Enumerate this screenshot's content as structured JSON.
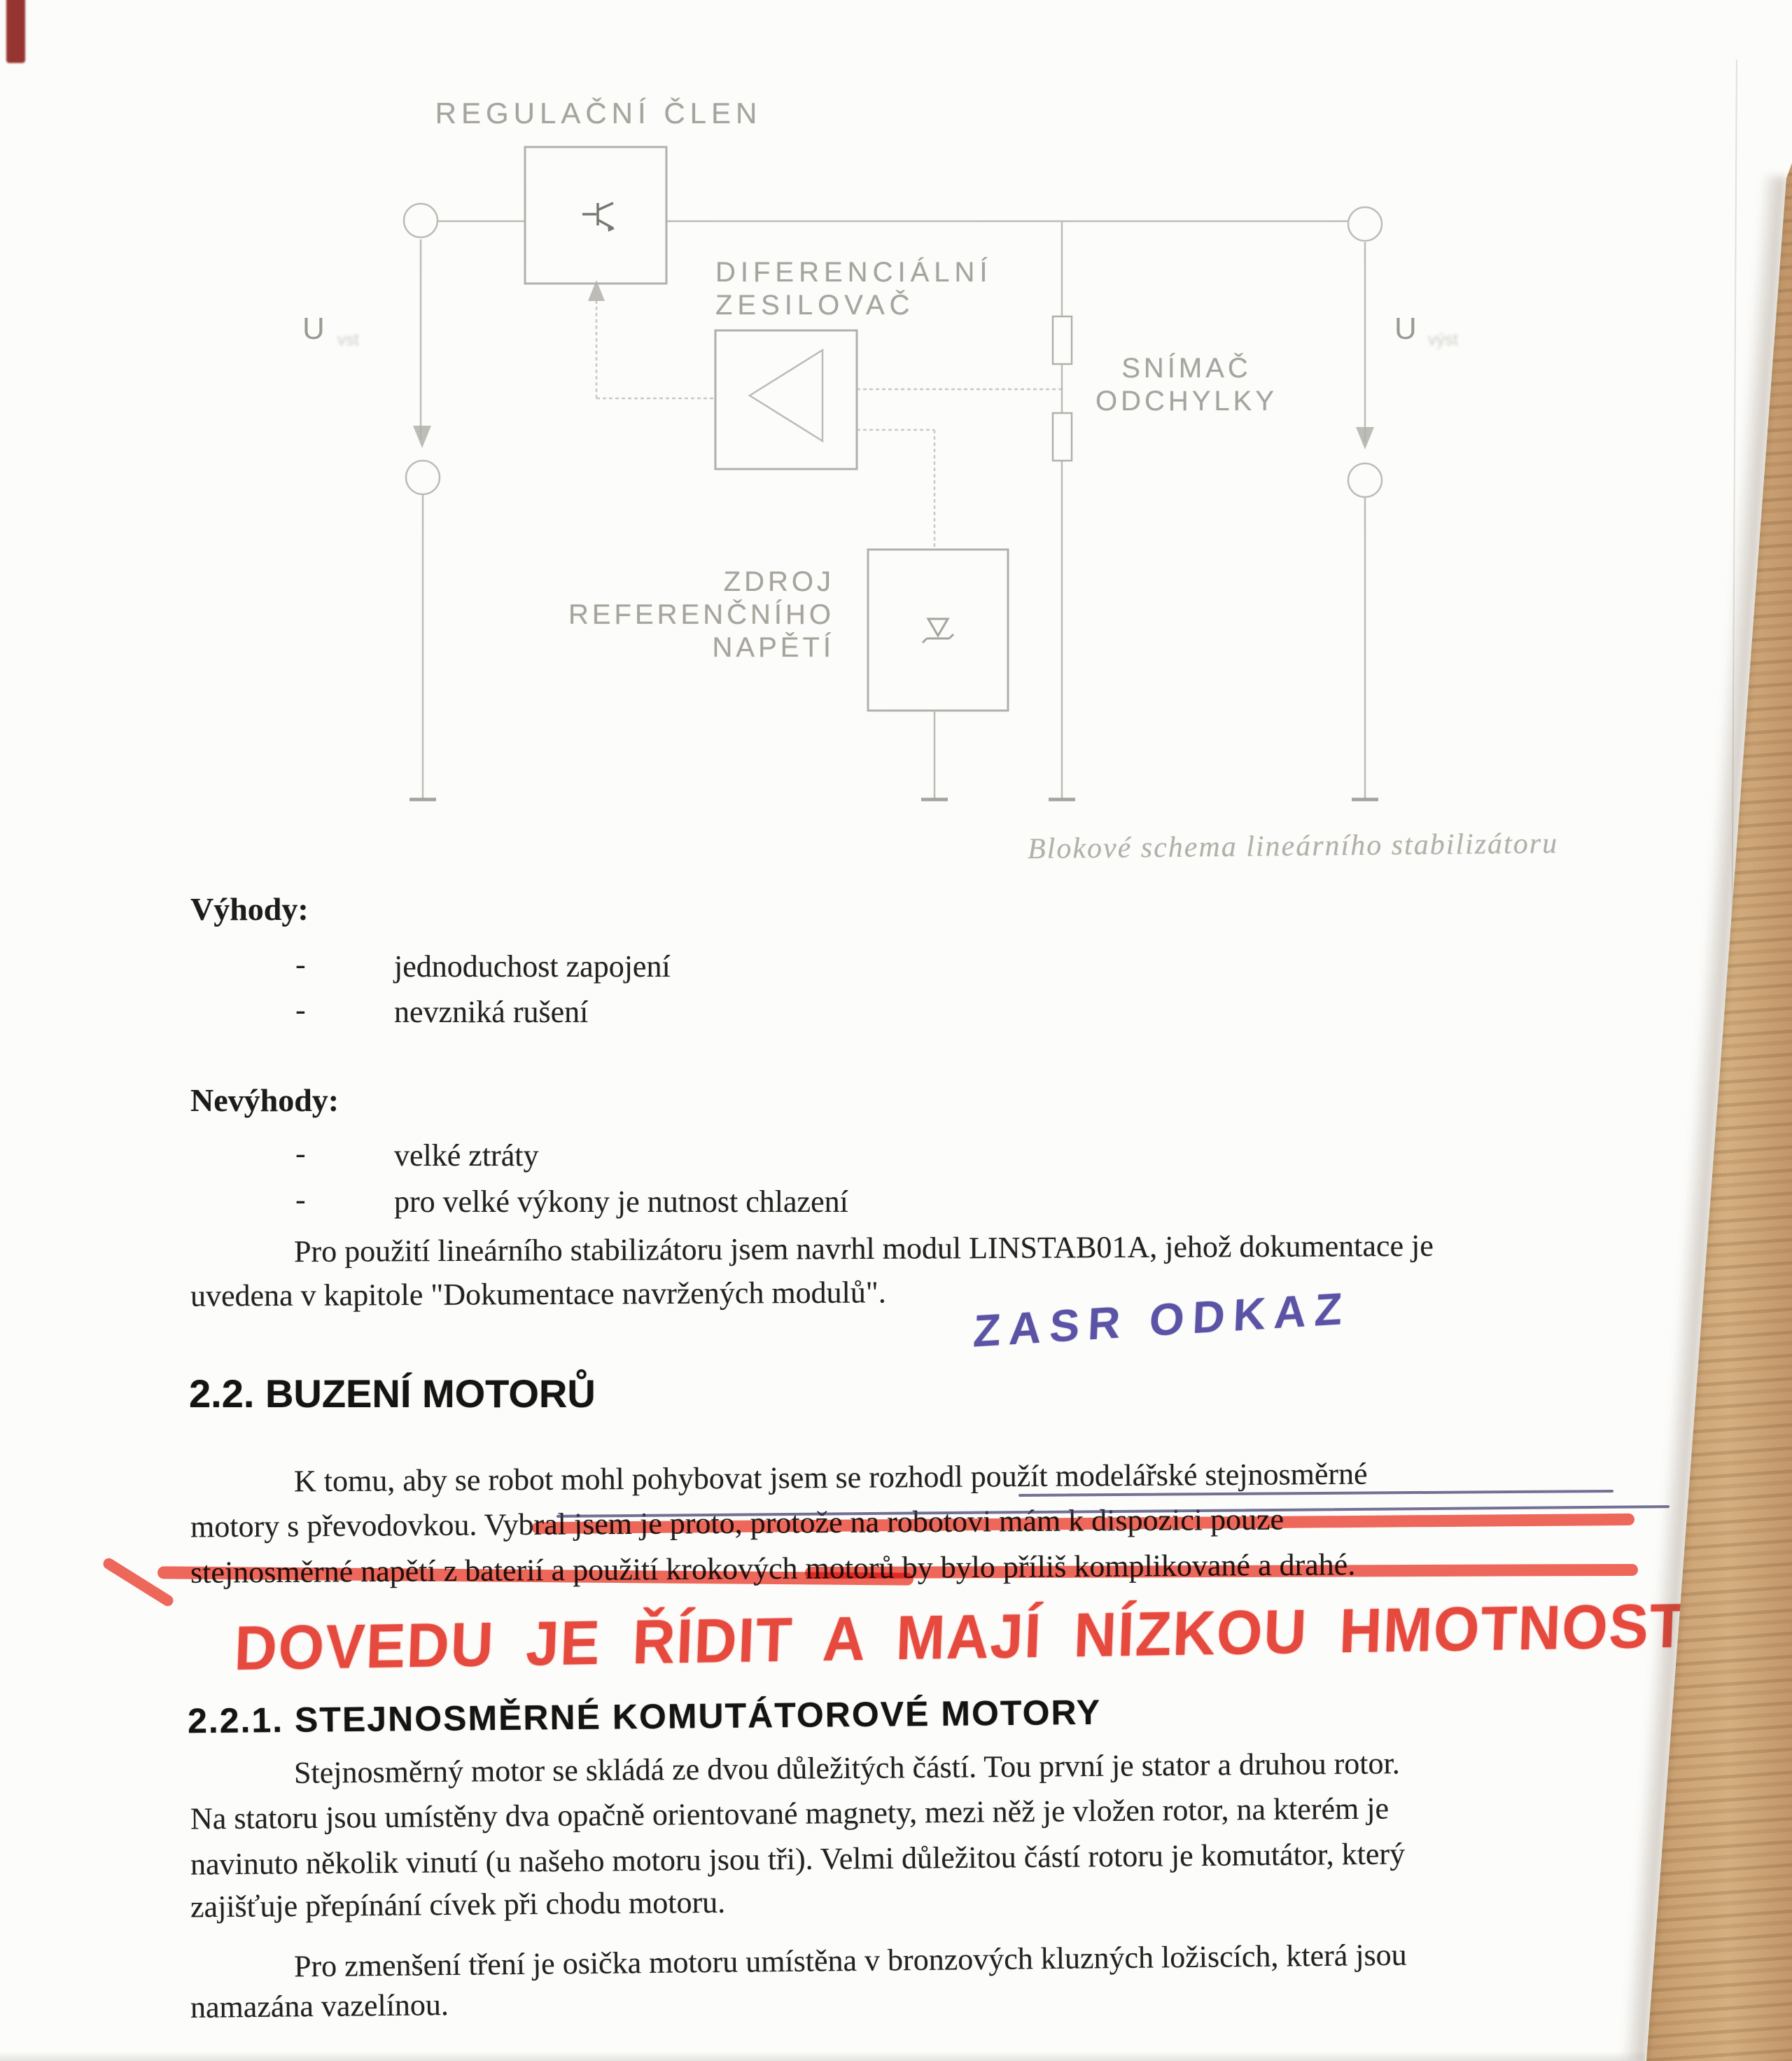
{
  "diagram": {
    "caption": "Blokové schema lineárního stabilizátoru",
    "labels": {
      "regulator": "REGULAČNÍ ČLEN",
      "diff_amp_line1": "DIFERENCIÁLNÍ",
      "diff_amp_line2": "ZESILOVAČ",
      "sensor_line1": "SNÍMAČ",
      "sensor_line2": "ODCHYLKY",
      "reference_line1": "ZDROJ",
      "reference_line2": "REFERENČNÍHO",
      "reference_line3": "NAPĚTÍ",
      "u_input": "U",
      "u_input_sub": "vst",
      "u_output": "U",
      "u_output_sub": "výst"
    }
  },
  "advantages": {
    "heading": "Výhody:",
    "bullet": "-",
    "items": [
      "jednoduchost zapojení",
      "nevzniká rušení"
    ]
  },
  "disadvantages": {
    "heading": "Nevýhody:",
    "bullet": "-",
    "items": [
      "velké ztráty",
      "pro velké výkony je nutnost chlazení"
    ]
  },
  "paragraph_linstab": {
    "line1": "Pro použití lineárního stabilizátoru jsem navrhl modul LINSTAB01A, jehož dokumentace je",
    "line2": "uvedena v kapitole \"Dokumentace navržených modulů\"."
  },
  "handwriting": {
    "blue_note": "ZASR ODKAZ",
    "red_note": "DOVEDU JE ŘÍDIT A MAJÍ NÍZKOU HMOTNOST"
  },
  "section_2_2": {
    "heading": "2.2. BUZENÍ MOTORŮ",
    "line1": "K tomu, aby se robot mohl pohybovat jsem se rozhodl použít modelářské stejnosměrné",
    "line2": "motory s převodovkou. Vybral jsem je proto, protože na robotovi mám k dispozici pouze",
    "line3": "stejnosměrné napětí z baterií a použití krokových motorů by bylo příliš komplikované a drahé."
  },
  "section_2_2_1": {
    "heading": "2.2.1. STEJNOSMĚRNÉ KOMUTÁTOROVÉ MOTORY",
    "line1": "Stejnosměrný motor se skládá ze dvou důležitých částí. Tou první je stator a druhou rotor.",
    "line2": "Na statoru jsou umístěny dva opačně orientované magnety, mezi něž je vložen rotor, na kterém je",
    "line3": "navinuto několik vinutí (u našeho motoru jsou tři). Velmi důležitou částí rotoru je komutátor, který",
    "line4": "zajišťuje přepínání cívek při chodu motoru."
  },
  "paragraph_bearings": {
    "line1": "Pro zmenšení tření je osička motoru umístěna v bronzových kluzných ložiscích, která jsou",
    "line2": "namazána vazelínou."
  },
  "colors": {
    "red_marker": "#e8473c",
    "blue_pen": "#5b54a6",
    "wood": "#c29668",
    "diagram_gray": "#a9a7a1",
    "ink": "#23221f"
  }
}
